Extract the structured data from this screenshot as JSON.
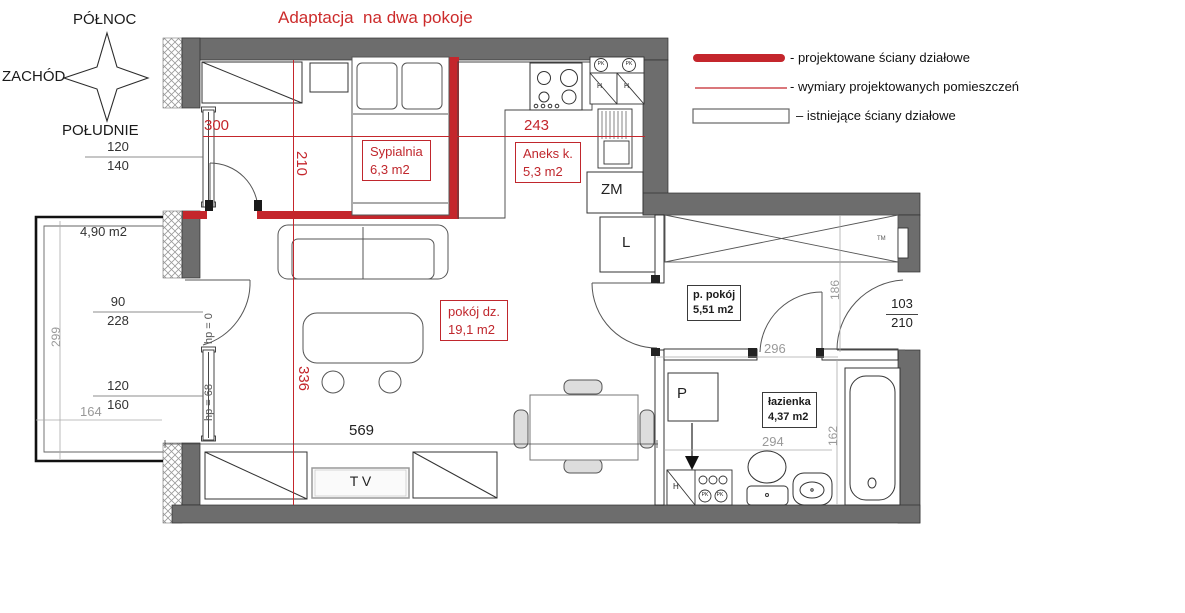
{
  "title": "Adaptacja  na dwa pokoje",
  "compass": {
    "north": "PÓŁNOC",
    "west": "ZACHÓD",
    "south": "POŁUDNIE"
  },
  "legend": {
    "projected_walls": "- projektowane ściany działowe",
    "projected_dims": "- wymiary projektowanych pomieszczeń",
    "existing_walls": "– istniejące ściany działowe"
  },
  "rooms": {
    "bedroom": {
      "name": "Sypialnia",
      "area": "6,3 m2"
    },
    "kitchenette": {
      "name": "Aneks k.",
      "area": "5,3 m2"
    },
    "living": {
      "name": "pokój dz.",
      "area": "19,1 m2"
    },
    "hall": {
      "name": "p. pokój",
      "area": "5,51 m2"
    },
    "bathroom": {
      "name": "łazienka",
      "area": "4,37 m2"
    },
    "balcony": {
      "area": "4,90 m2"
    }
  },
  "appliances": {
    "dishwasher": "ZM",
    "fridge": "L",
    "washer": "P",
    "tv": "T V",
    "tm": "TM",
    "h": "H",
    "pk": "PK"
  },
  "dims": {
    "d300": "300",
    "d243": "243",
    "d210": "210",
    "d336": "336",
    "d569": "569",
    "d120a": "120",
    "d140": "140",
    "d90": "90",
    "d228": "228",
    "d120b": "120",
    "d160": "160",
    "d299": "299",
    "d164": "164",
    "d186": "186",
    "d296": "296",
    "d294": "294",
    "d162": "162",
    "d103": "103",
    "d210b": "210",
    "hp0": "hp = 0",
    "hp68": "hp = 68"
  },
  "colors": {
    "wall_gray": "#6d6d6d",
    "red": "#c4262c",
    "title_red": "#cc2b2b"
  }
}
